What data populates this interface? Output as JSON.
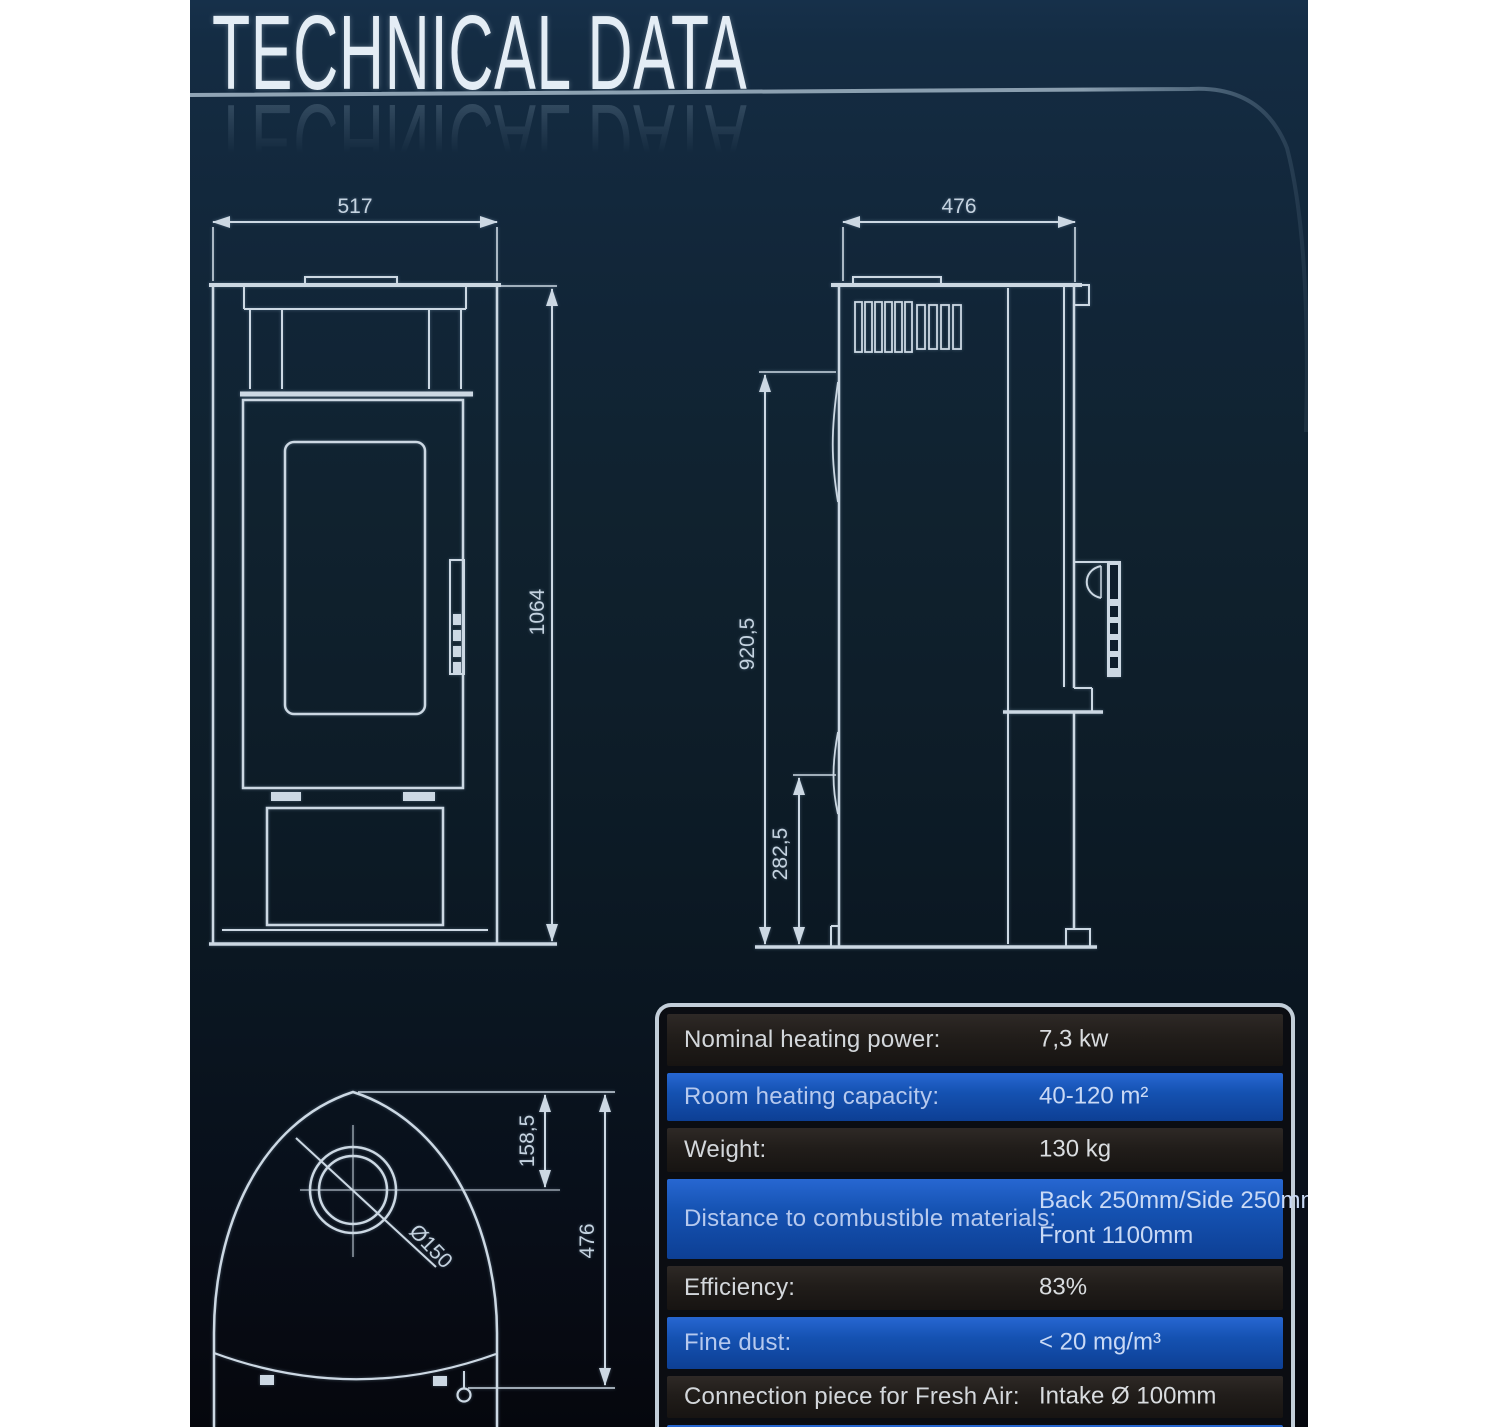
{
  "header": {
    "title": "TECHNICAL DATA"
  },
  "front_view": {
    "width_dim": "517",
    "height_dim": "1064"
  },
  "side_view": {
    "depth_dim": "476",
    "flue_height_dim": "920,5",
    "intake_height_dim": "282,5"
  },
  "top_view": {
    "flue_offset_dim": "158,5",
    "depth_dim": "476",
    "flue_diameter_dim": "Ø150"
  },
  "spec_table": {
    "rows": [
      {
        "label": "Nominal heating power:",
        "value": "7,3 kw"
      },
      {
        "label": "Room heating capacity:",
        "value": "40-120 m²"
      },
      {
        "label": "Weight:",
        "value": "130 kg"
      },
      {
        "label": "Distance to combustible materials:",
        "value": "Back 250mm/Side 250mm/",
        "value2": "Front 1100mm"
      },
      {
        "label": "Efficiency:",
        "value": "83%"
      },
      {
        "label": "Fine dust:",
        "value": "< 20 mg/m³"
      },
      {
        "label": "Connection piece for Fresh Air:",
        "value": "Intake Ø 100mm"
      }
    ]
  },
  "colors": {
    "background_top": "#15293d",
    "background_bottom": "#06080f",
    "drawing_line": "#ccd8e3",
    "table_border": "#c2ced9",
    "blue_row": "#1552b2",
    "dark_row": "#221e1b"
  }
}
